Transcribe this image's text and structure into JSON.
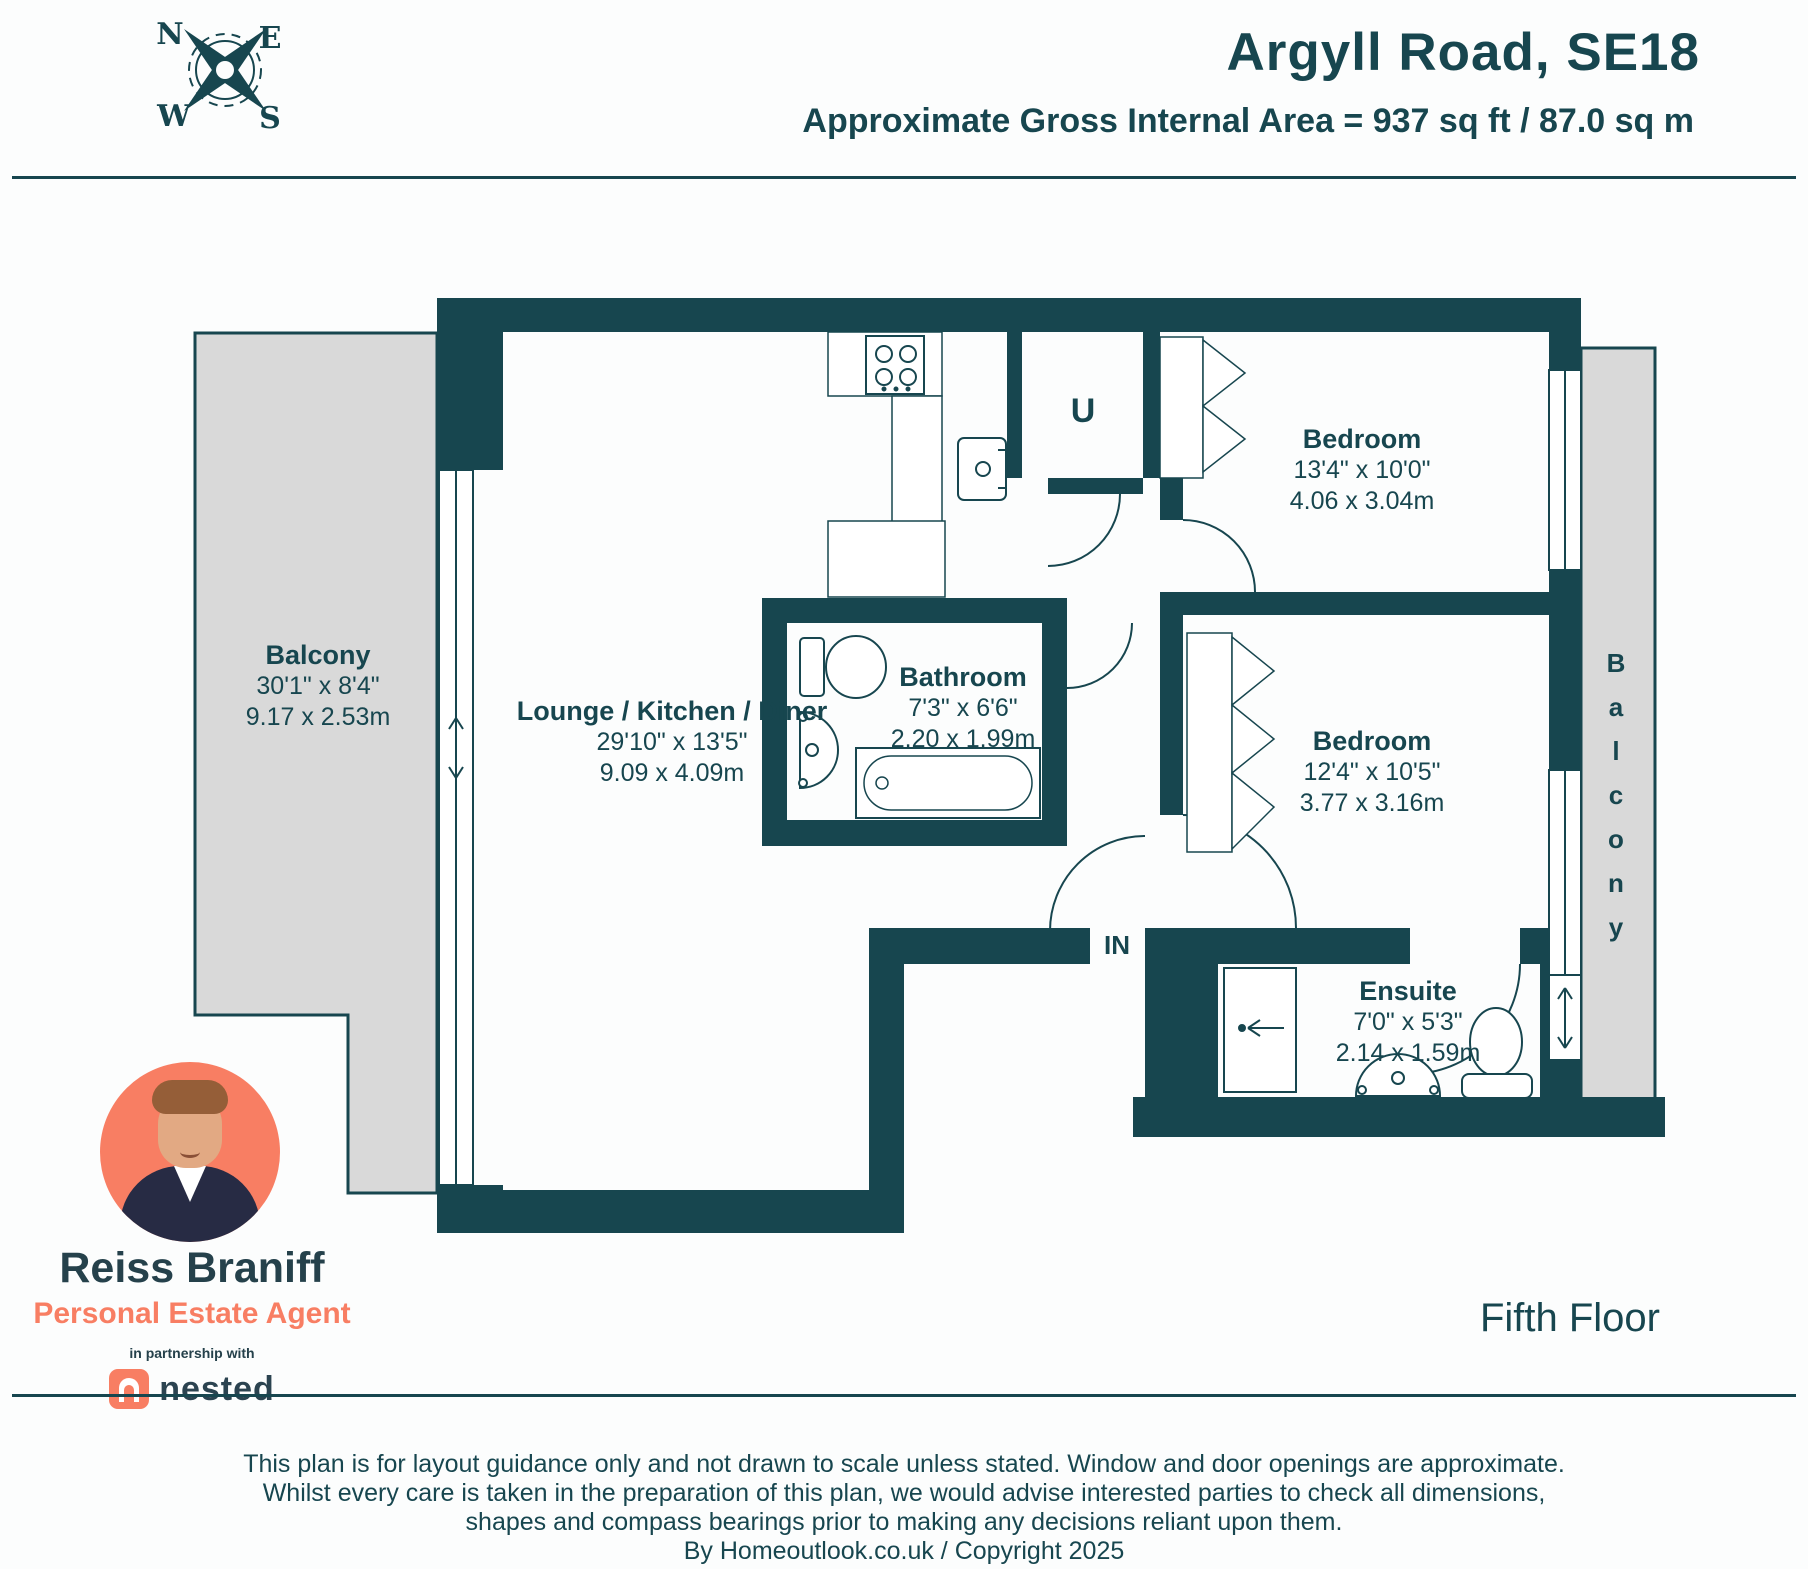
{
  "header": {
    "title": "Argyll Road, SE18",
    "area": "Approximate Gross Internal Area = 937 sq ft / 87.0 sq m"
  },
  "compass": {
    "n": "N",
    "e": "E",
    "w": "W",
    "s": "S"
  },
  "plan": {
    "balcony_left": {
      "name": "Balcony",
      "ft": "30'1\" x 8'4\"",
      "m": "9.17 x 2.53m"
    },
    "lounge": {
      "name": "Lounge / Kitchen / Diner",
      "ft": "29'10\" x 13'5\"",
      "m": "9.09 x 4.09m"
    },
    "bathroom": {
      "name": "Bathroom",
      "ft": "7'3\" x 6'6\"",
      "m": "2.20 x 1.99m"
    },
    "bedroom1": {
      "name": "Bedroom",
      "ft": "13'4\" x 10'0\"",
      "m": "4.06 x 3.04m"
    },
    "bedroom2": {
      "name": "Bedroom",
      "ft": "12'4\" x 10'5\"",
      "m": "3.77 x 3.16m"
    },
    "ensuite": {
      "name": "Ensuite",
      "ft": "7'0\" x 5'3\"",
      "m": "2.14 x 1.59m"
    },
    "balcony_right": {
      "name": "Balcony"
    },
    "utility": "U",
    "entrance": "IN"
  },
  "agent": {
    "name": "Reiss Braniff",
    "role": "Personal Estate Agent",
    "partnership": "in partnership with",
    "brand": "nested"
  },
  "floor": "Fifth Floor",
  "disclaimer": [
    "This plan is for layout guidance only and not drawn to scale unless stated. Window and door openings are approximate.",
    "Whilst every care is taken in the preparation of this plan, we would advise interested parties to check all dimensions,",
    "shapes and compass bearings prior to making any decisions reliant upon them.",
    "By Homeoutlook.co.uk / Copyright 2025"
  ],
  "colors": {
    "teal": "#17464F",
    "coral": "#F87E63",
    "balcony_gray": "#D9D9D9"
  }
}
